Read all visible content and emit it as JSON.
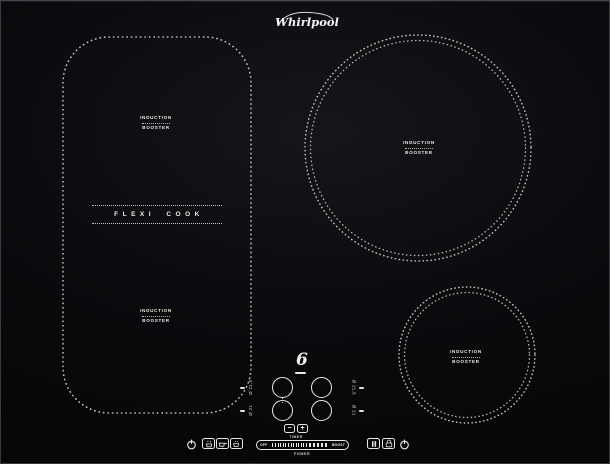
{
  "brand": {
    "logo": "Whirlpool"
  },
  "zones": {
    "flexi_top": {
      "line1": "INDUCTION",
      "line2": "BOOSTER"
    },
    "flexi_center": {
      "label": "FLEXI COOK"
    },
    "flexi_bottom": {
      "line1": "INDUCTION",
      "line2": "BOOSTER"
    },
    "large_circle": {
      "line1": "INDUCTION",
      "line2": "BOOSTER"
    },
    "small_circle": {
      "line1": "INDUCTION",
      "line2": "BOOSTER"
    }
  },
  "controls": {
    "sixth_sense_mark": "6",
    "zone_buttons": {
      "top_left_size": "Ø 21,5",
      "bottom_left_size": "Ø 21",
      "top_right_size": "Ø 21,5",
      "bottom_right_size": "Ø 21"
    },
    "timer": {
      "minus": "−",
      "plus": "+",
      "label": "TIMER"
    },
    "power": {
      "off": "OFF",
      "boost": "BOOST",
      "label": "POWER",
      "thin_ticks": 14,
      "bold_ticks": 5
    },
    "icons": {
      "left": [
        "standby-icon",
        "steam-pot-icon",
        "frying-pan-icon",
        "saucepan-icon"
      ],
      "right": [
        "pause-icon",
        "lock-icon",
        "standby-icon"
      ]
    }
  },
  "colors": {
    "glass": "#0a0a0d",
    "zone_dots": "#c9c3b3",
    "panel_marks": "#e9e9e7",
    "label_text": "#ece9e0"
  }
}
